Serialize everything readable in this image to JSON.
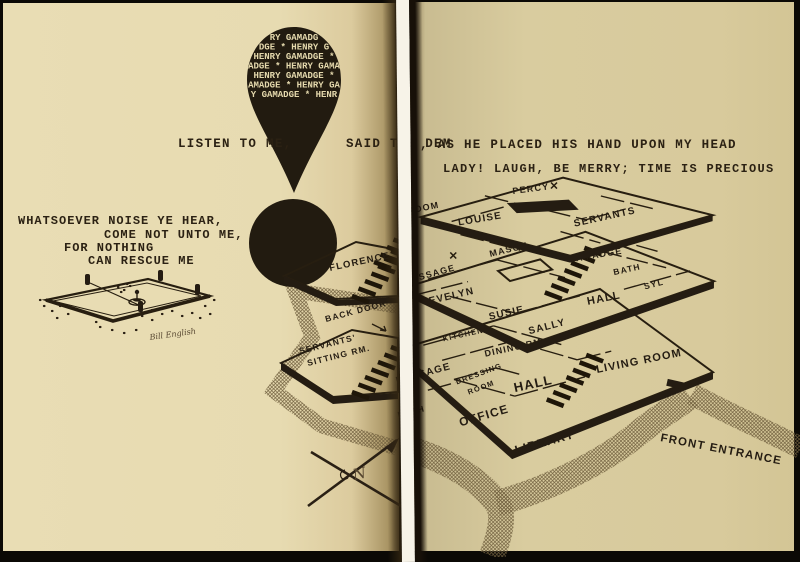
{
  "exclamation": {
    "rows": [
      "RY GAMADG",
      "DGE * HENRY G",
      "HENRY GAMADGE *",
      "ADGE * HENRY GAMA",
      "HENRY GAMADGE *",
      "AMADGE * HENRY GA",
      "Y GAMADGE * HENR"
    ]
  },
  "quotes": {
    "listen_left": "LISTEN TO ME,",
    "listen_mid": "SAID THE DEM",
    "listen_right": ", AS HE PLACED HIS HAND UPON MY HEAD",
    "lady": "LADY!  LAUGH, BE MERRY; TIME IS PRECIOUS",
    "whatsoever_1": "WHATSOEVER NOISE YE HEAR,",
    "whatsoever_2": "COME NOT UNTO ME,",
    "whatsoever_3": "FOR NOTHING",
    "whatsoever_4": "CAN RESCUE ME"
  },
  "floor3": {
    "room": "ROOM",
    "percy": "PERCY",
    "louise": "LOUISE",
    "servants": "SERVANTS"
  },
  "floor2": {
    "passage": "PASSAGE",
    "mason": "MASON",
    "gamadge": "GAMADGE",
    "bath": "BATH",
    "syl": "SYL",
    "evelyn": "EVELYN",
    "hall": "HALL",
    "susie": "SUSIE",
    "sally": "SALLY",
    "florence": "FLORENCE"
  },
  "floor1": {
    "back_door": "BACK DOOR",
    "servants_sitting_1": "SERVANTS'",
    "servants_sitting_2": "SITTING RM.",
    "passage": "PASSAGE",
    "kitchen": "KITCHEN",
    "dining_rm": "DINING RM.",
    "dressing_1": "DRESSING",
    "dressing_2": "ROOM",
    "hall": "HALL",
    "living_room": "LIVING ROOM",
    "bath": "BATH",
    "office": "OFFICE",
    "library": "LIBRARY"
  },
  "site": {
    "front_entrance": "FRONT ENTRANCE",
    "north_letter": "N",
    "signature": "Bill English"
  },
  "colors": {
    "paper_left": "#e6dab0",
    "paper_right": "#d8cb9e",
    "ink": "#261e12",
    "gutter_white": "#f7f3e8"
  }
}
